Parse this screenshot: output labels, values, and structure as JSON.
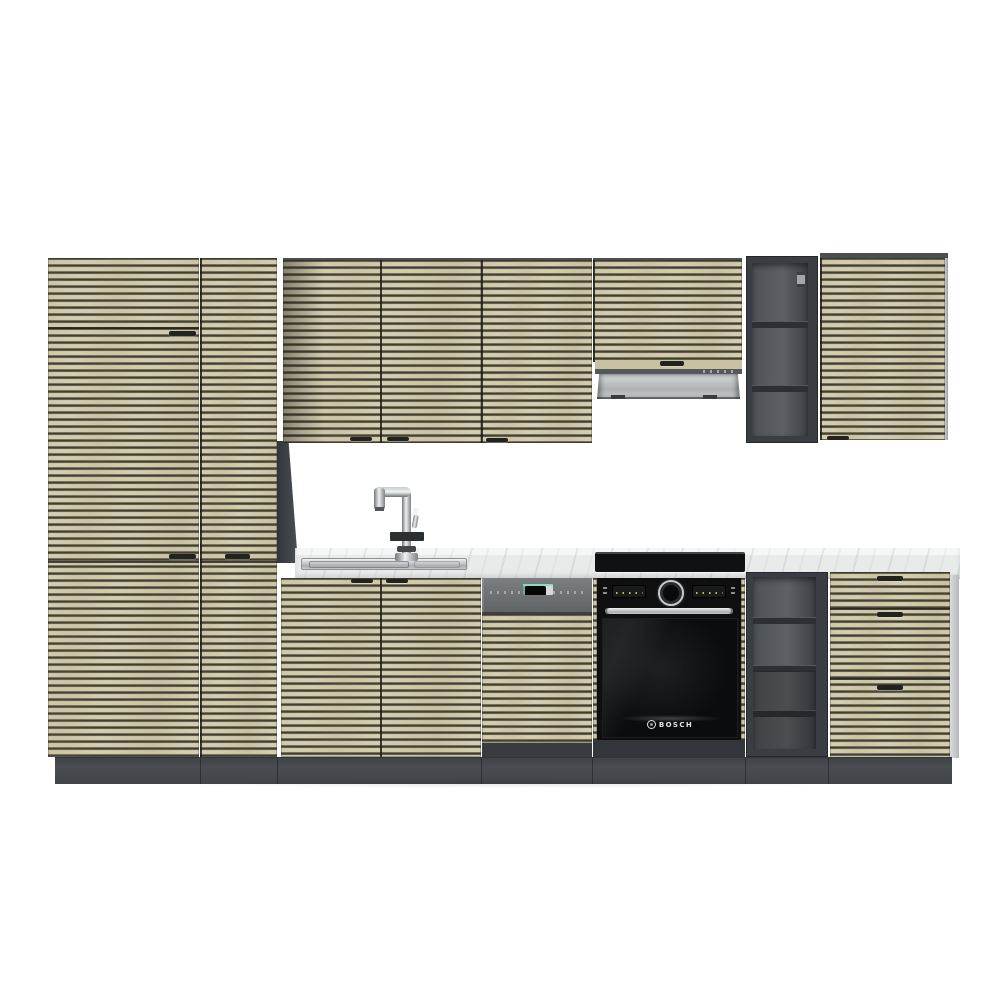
{
  "brand": {
    "oven_logo_text": "BOSCH"
  },
  "palette": {
    "background": "#ffffff",
    "front_slat_beige": "#d6cfb1",
    "slat_gap_dark": "#35342b",
    "carcass_gray": "#3f4347",
    "open_shelf_interior": "#565a5e",
    "plinth_gray": "#45484b",
    "countertop_marble": "#edefef",
    "stainless_steel": "#c6c9cb",
    "appliance_black": "#0f0f10",
    "handle_dark": "#23231f"
  },
  "icons": {
    "oven_brand_emblem": "bosch-circle-icon",
    "faucet": "kitchen-mixer-tap-icon"
  }
}
